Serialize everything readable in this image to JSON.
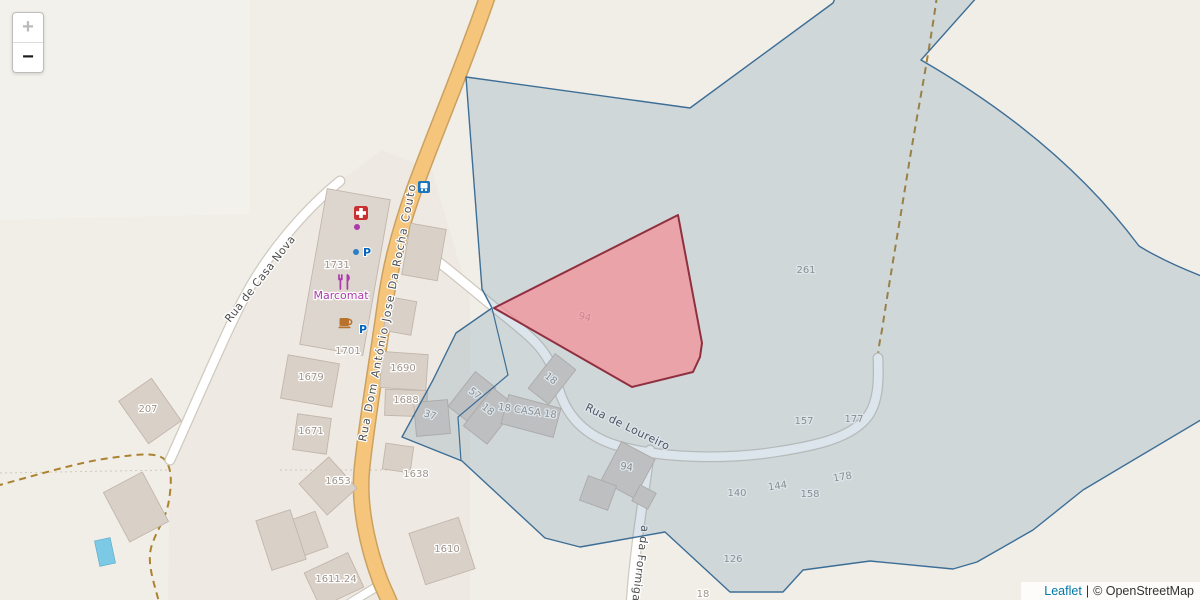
{
  "map": {
    "zoom_control": {
      "zoom_in_label": "+",
      "zoom_out_label": "−"
    },
    "attribution": {
      "leaflet_label": "Leaflet",
      "separator": "|",
      "osm_label": "© OpenStreetMap"
    },
    "street_labels": [
      {
        "text": "Rua de Casa Nova",
        "x": 263,
        "y": 281,
        "rotate": -52
      },
      {
        "text": "Rua Dom António Jose Da Rocha Couto",
        "x": 391,
        "y": 313,
        "rotate": -79,
        "ls": 1.4
      },
      {
        "text": "Rua de Loureiro",
        "x": 626,
        "y": 430,
        "rotate": 26
      },
      {
        "text": "a da Formiga",
        "x": 637,
        "y": 563,
        "rotate": 97
      }
    ],
    "place_labels": [
      {
        "text": "Marcomat",
        "x": 341,
        "y": 299
      }
    ],
    "parking_letter": "P",
    "parking_positions": [
      {
        "x": 367,
        "y": 256
      },
      {
        "x": 363,
        "y": 333
      }
    ],
    "housenumbers": [
      {
        "text": "207",
        "x": 148,
        "y": 412
      },
      {
        "text": "1731",
        "x": 337,
        "y": 268
      },
      {
        "text": "1701",
        "x": 348,
        "y": 354
      },
      {
        "text": "1679",
        "x": 311,
        "y": 380
      },
      {
        "text": "1690",
        "x": 403,
        "y": 371
      },
      {
        "text": "1688",
        "x": 406,
        "y": 403
      },
      {
        "text": "1671",
        "x": 311,
        "y": 434
      },
      {
        "text": "1653",
        "x": 338,
        "y": 484
      },
      {
        "text": "1638",
        "x": 416,
        "y": 477
      },
      {
        "text": "1610",
        "x": 447,
        "y": 552
      },
      {
        "text": "1611.24",
        "x": 336,
        "y": 582
      },
      {
        "text": "37",
        "x": 429,
        "y": 418,
        "rotate": 18
      },
      {
        "text": "57",
        "x": 473,
        "y": 396,
        "rotate": 38
      },
      {
        "text": "18",
        "x": 486,
        "y": 412,
        "rotate": 38
      },
      {
        "text": "18 CASA 18",
        "x": 527,
        "y": 414,
        "rotate": 8
      },
      {
        "text": "18",
        "x": 549,
        "y": 381,
        "rotate": 38
      },
      {
        "text": "94",
        "x": 584,
        "y": 320,
        "rotate": 14
      },
      {
        "text": "94",
        "x": 626,
        "y": 470,
        "rotate": 10
      },
      {
        "text": "261",
        "x": 806,
        "y": 273
      },
      {
        "text": "157",
        "x": 804,
        "y": 424
      },
      {
        "text": "177",
        "x": 854,
        "y": 422
      },
      {
        "text": "178",
        "x": 843,
        "y": 480,
        "rotate": -10
      },
      {
        "text": "144",
        "x": 778,
        "y": 489,
        "rotate": -8
      },
      {
        "text": "158",
        "x": 810,
        "y": 497
      },
      {
        "text": "140",
        "x": 737,
        "y": 496
      },
      {
        "text": "126",
        "x": 733,
        "y": 562
      },
      {
        "text": "18",
        "x": 703,
        "y": 597
      }
    ],
    "icons": [
      "pharmacy-icon",
      "restaurant-icon",
      "cafe-icon",
      "bus-stop-icon",
      "parking-icon",
      "shop-node-icon",
      "swimming-pool"
    ],
    "colors": {
      "background": "#f1eee8",
      "residential_tint": "#e9e2da",
      "road_main_fill": "#f4c57b",
      "road_main_casing": "#cba160",
      "road_white_fill": "#ffffff",
      "road_white_casing": "#cfc9c0",
      "track_dashed": "#ab8330",
      "building_fill": "#d9d0c8",
      "building_outline": "#c2b6ab",
      "overlay_polygon_stroke": "#3d6e96",
      "overlay_polygon_fill": "rgba(82,125,158,0.20)",
      "parcel_polygon_stroke": "#8f2f3f",
      "parcel_polygon_fill": "rgba(248,130,138,0.62)",
      "housenumber_text": "#9d938a",
      "street_text": "#4e4e4e",
      "shop_purple": "#ac39ac",
      "pharmacy_red": "#c9302f",
      "cafe_brown": "#b8722c",
      "bus_blue": "#1a75bc",
      "parking_blue": "#0065bf",
      "pool_blue": "#7bc9e4",
      "leaflet_link": "#0078a8"
    }
  }
}
